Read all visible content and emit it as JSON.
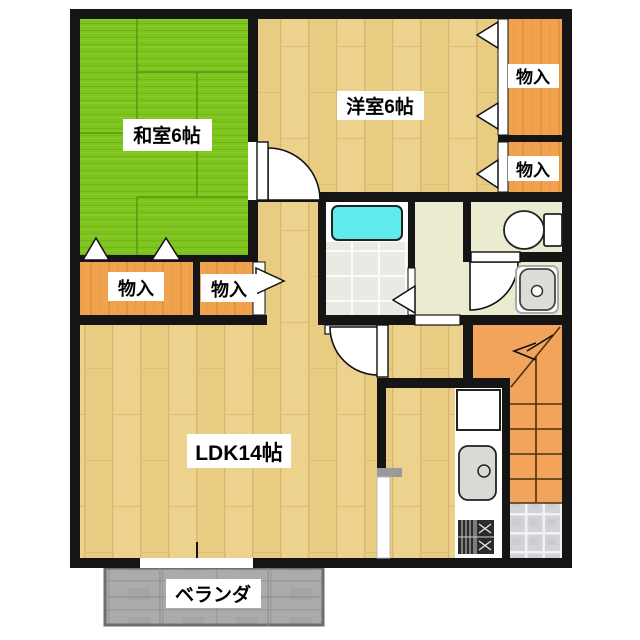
{
  "floorplan": {
    "rooms": {
      "washitsu": {
        "label": "和室6帖"
      },
      "youshitsu": {
        "label": "洋室6帖"
      },
      "ldk": {
        "label": "LDK14帖"
      },
      "veranda": {
        "label": "ベランダ"
      },
      "storage_right_top": {
        "label": "物入"
      },
      "storage_right_mid": {
        "label": "物入"
      },
      "storage_left_large": {
        "label": "物入"
      },
      "storage_left_small": {
        "label": "物入"
      }
    },
    "fixtures": [
      "bathtub",
      "toilet",
      "washbasin",
      "kitchen-sink",
      "gas-stove",
      "refrigerator-space",
      "staircase-with-up-arrow",
      "entry-tile",
      "balcony-window"
    ],
    "colors": {
      "wall": "#151515",
      "tatami_green": "#7EC41F",
      "wood_floor": "#ECD28C",
      "closet_orange": "#F0A24E",
      "stairs_orange": "#F2A45C",
      "washroom_cream": "#EBEBCF",
      "bathtub_cyan": "#5FEAEC",
      "bath_tile": "#EAEAE5",
      "entry_tile": "#D2D2D7",
      "veranda_gray": "#ABABAB"
    }
  }
}
